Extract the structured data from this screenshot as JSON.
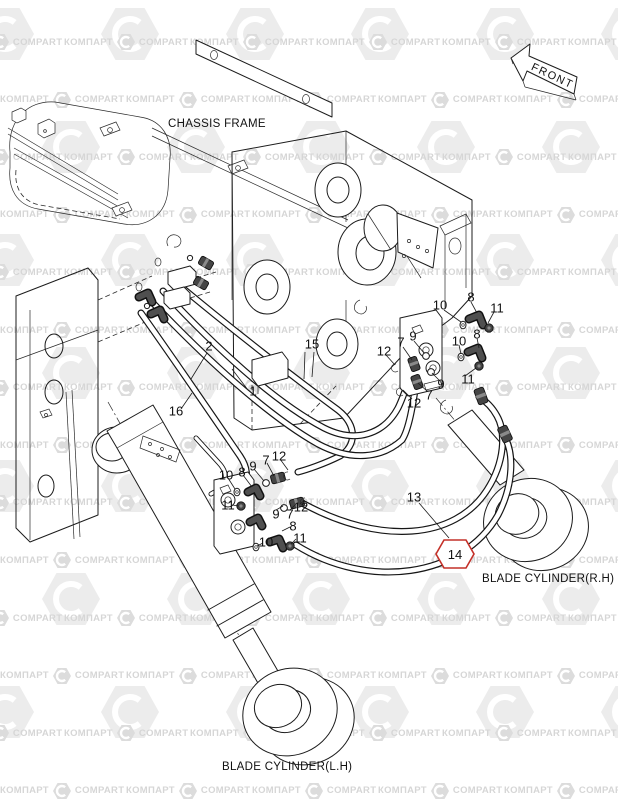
{
  "captions": {
    "chassis_frame": "CHASSIS FRAME",
    "front_arrow": "FRONT",
    "blade_cylinder_rh": "BLADE CYLINDER(R.H)",
    "blade_cylinder_lh": "BLADE CYLINDER(L.H)"
  },
  "highlight": {
    "part_number": "14",
    "shape": "hexagon",
    "color": "#c43028"
  },
  "part_labels": [
    {
      "n": "1",
      "x": 253,
      "y": 391
    },
    {
      "n": "2",
      "x": 209,
      "y": 346
    },
    {
      "n": "15",
      "x": 312,
      "y": 344
    },
    {
      "n": "16",
      "x": 176,
      "y": 411
    },
    {
      "n": "13",
      "x": 414,
      "y": 497
    },
    {
      "n": "10",
      "x": 440,
      "y": 305
    },
    {
      "n": "8",
      "x": 471,
      "y": 297
    },
    {
      "n": "11",
      "x": 497,
      "y": 308
    },
    {
      "n": "8",
      "x": 477,
      "y": 334
    },
    {
      "n": "10",
      "x": 459,
      "y": 341
    },
    {
      "n": "9",
      "x": 413,
      "y": 336
    },
    {
      "n": "7",
      "x": 401,
      "y": 342
    },
    {
      "n": "12",
      "x": 384,
      "y": 351
    },
    {
      "n": "9",
      "x": 441,
      "y": 384
    },
    {
      "n": "11",
      "x": 468,
      "y": 379
    },
    {
      "n": "7",
      "x": 429,
      "y": 395
    },
    {
      "n": "12",
      "x": 414,
      "y": 403
    },
    {
      "n": "12",
      "x": 279,
      "y": 456
    },
    {
      "n": "7",
      "x": 266,
      "y": 460
    },
    {
      "n": "9",
      "x": 253,
      "y": 466
    },
    {
      "n": "8",
      "x": 242,
      "y": 472
    },
    {
      "n": "10",
      "x": 226,
      "y": 475
    },
    {
      "n": "11",
      "x": 228,
      "y": 505
    },
    {
      "n": "9",
      "x": 276,
      "y": 514
    },
    {
      "n": "7",
      "x": 290,
      "y": 514
    },
    {
      "n": "12",
      "x": 301,
      "y": 507
    },
    {
      "n": "8",
      "x": 293,
      "y": 526
    },
    {
      "n": "11",
      "x": 300,
      "y": 538
    },
    {
      "n": "10",
      "x": 266,
      "y": 542
    }
  ],
  "watermark": {
    "cyrillic": "КОМПАРТ",
    "latin": "COMPART"
  }
}
